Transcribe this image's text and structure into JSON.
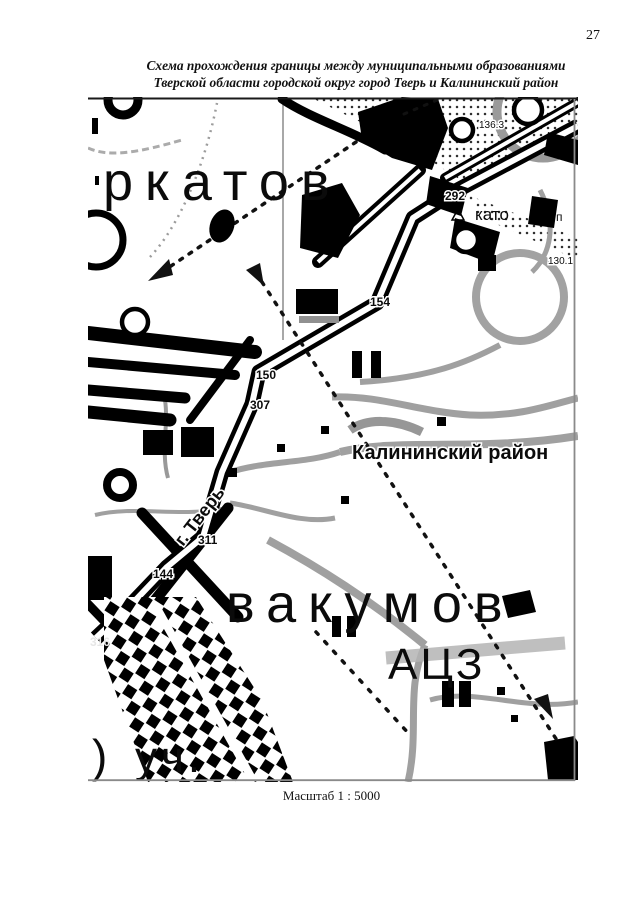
{
  "page": {
    "number": "27",
    "title_line1": "Схема прохождения границы между муниципальными образованиями",
    "title_line2": "Тверской области городской округ город Тверь и Калининский район",
    "scale_caption": "Масштаб 1 : 5000"
  },
  "map": {
    "region_labels": {
      "district": "Калининский район",
      "city": "г. Тверь",
      "settlement_top_partial": "ркатов",
      "settlement_bottom_partial": "вакумов",
      "settlement_small_partial": "като",
      "facility": "АЦЗ",
      "bottom_left_bracket": ")",
      "bottom_left_text": "уч.",
      "letter_p": "п"
    },
    "boundary_points": [
      "292",
      "154",
      "150",
      "307",
      "311",
      "144",
      "316"
    ],
    "elevation_marks": [
      "136.3",
      "130.1"
    ]
  },
  "colors": {
    "ink": "#111111",
    "map_gray": "#9e9e9e",
    "paper": "#ffffff"
  }
}
